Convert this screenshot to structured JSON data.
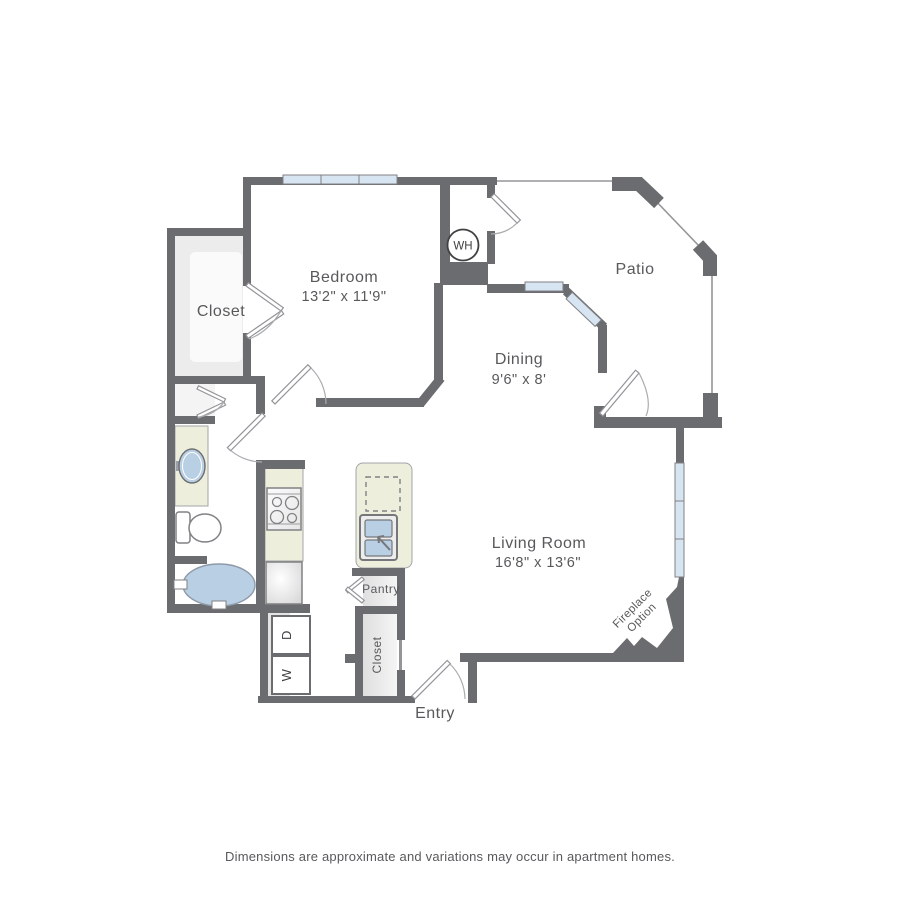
{
  "fp": {
    "rooms": {
      "bedroom": {
        "name": "Bedroom",
        "dims": "13'2\" x 11'9\""
      },
      "closet": {
        "name": "Closet"
      },
      "patio": {
        "name": "Patio"
      },
      "dining": {
        "name": "Dining",
        "dims": "9'6\" x 8'"
      },
      "living": {
        "name": "Living Room",
        "dims": "16'8\" x 13'6\""
      },
      "pantry": {
        "name": "Pantry"
      },
      "entry_closet": {
        "name": "Closet"
      },
      "entry": {
        "name": "Entry"
      }
    },
    "fixtures": {
      "water_heater": "WH",
      "washer": "W",
      "dryer": "D"
    },
    "annotations": {
      "fireplace_line1": "Fireplace",
      "fireplace_line2": "Option"
    },
    "footer": {
      "disclaimer": "Dimensions are approximate and variations may occur in apartment homes."
    },
    "colors": {
      "wall_gray": "#6b6c6f",
      "thin_line_gray": "#939598",
      "counter_cream": "#eeeedd",
      "fixture_blue": "#b9cfe4",
      "window_blue": "#d7e5f2",
      "closet_interior_gray": "#ececec",
      "label_gray": "#58595b"
    }
  }
}
